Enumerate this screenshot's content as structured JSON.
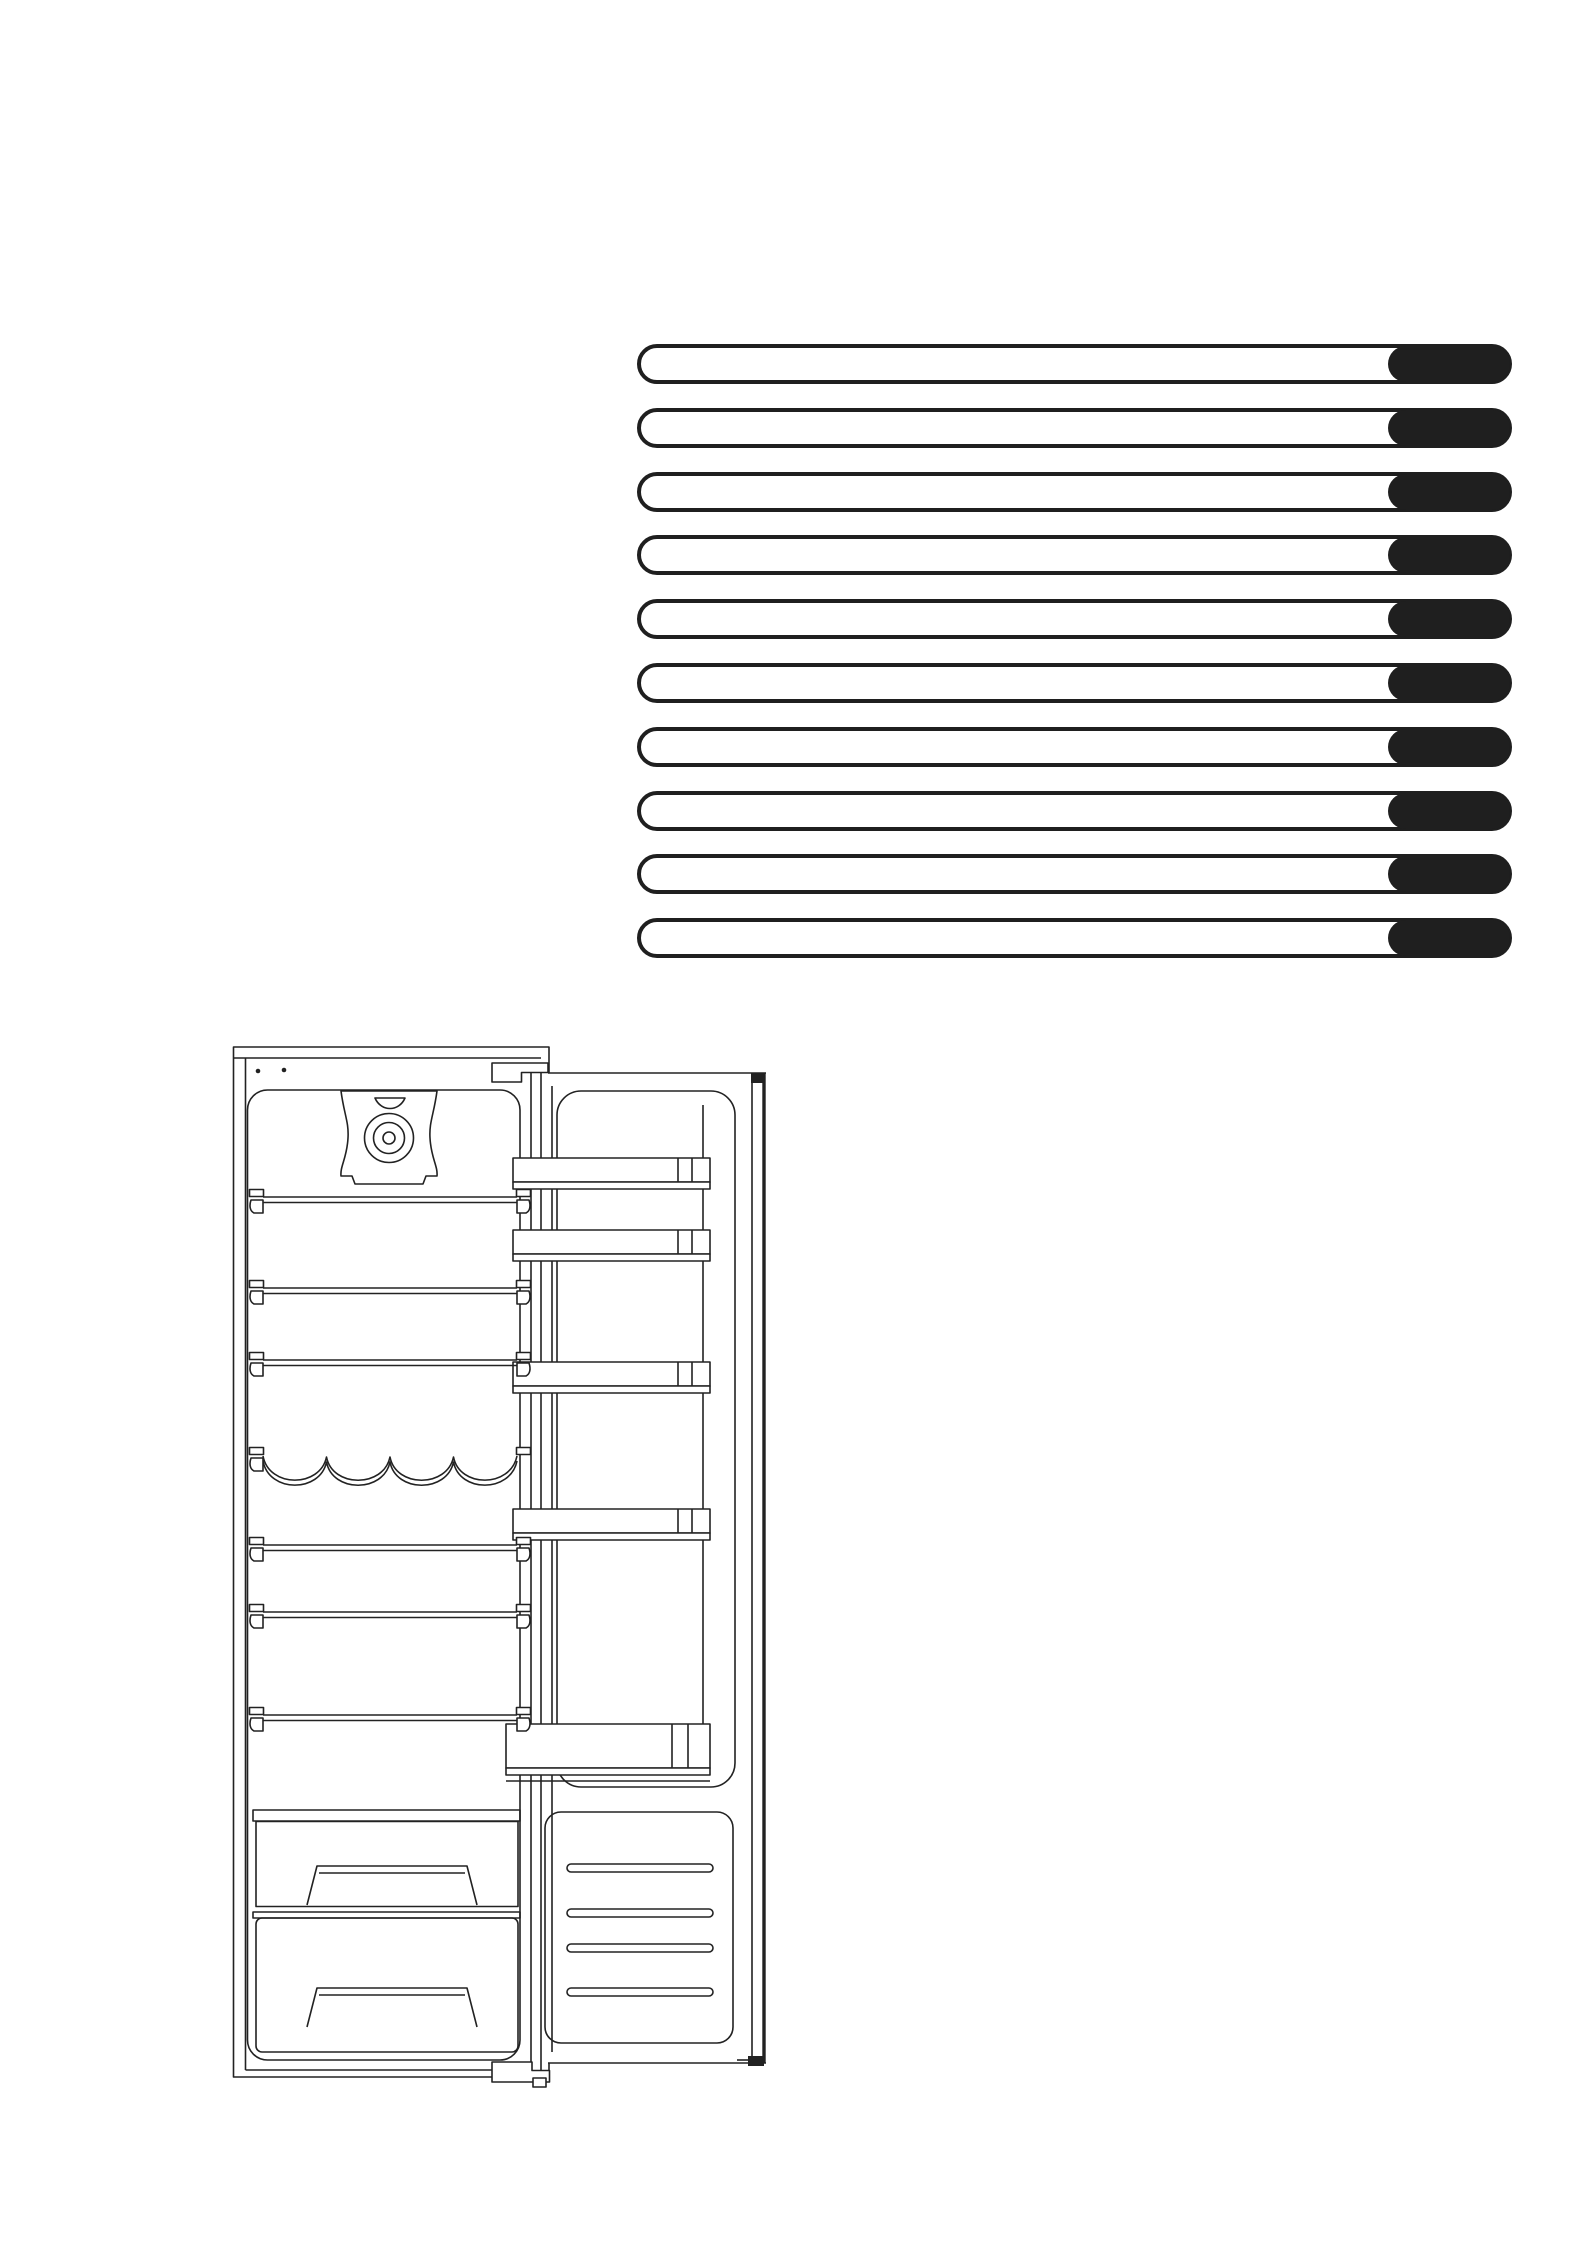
{
  "page": {
    "background": "#ffffff",
    "width": 1587,
    "height": 2245,
    "visible_text": ""
  },
  "redacted_text_bars": {
    "description": "ten horizontal pill-shaped placeholder text lines, white with black outline, each ending in a solid black rounded segment on the right",
    "count": 10,
    "outline_color": "#1f1f1f",
    "cap_color": "#1f1f1f",
    "bar_fill": "#ffffff",
    "geometry": {
      "left": 637,
      "top_first": 344,
      "row_pitch": 63.8,
      "bar_width": 875,
      "bar_height": 40,
      "border_width": 4,
      "corner_radius": 20,
      "cap_width": 122
    }
  },
  "illustration": {
    "name": "built-in refrigerator with open door, interior line drawing",
    "line_color": "#222222",
    "wire_shelf_count": 6,
    "wire_shelves_y": [
      1197,
      1288,
      1360,
      1545,
      1612,
      1715
    ],
    "wine_rack_scallops": 4,
    "door_balcony_count": 5,
    "door_balconies_y": [
      1158,
      1230,
      1362,
      1509
    ],
    "bottom_balcony_y": 1724,
    "crisper_drawer_count": 2,
    "vent_slot_count": 4,
    "vent_slots_y": [
      1864,
      1909,
      1944,
      1988
    ]
  }
}
